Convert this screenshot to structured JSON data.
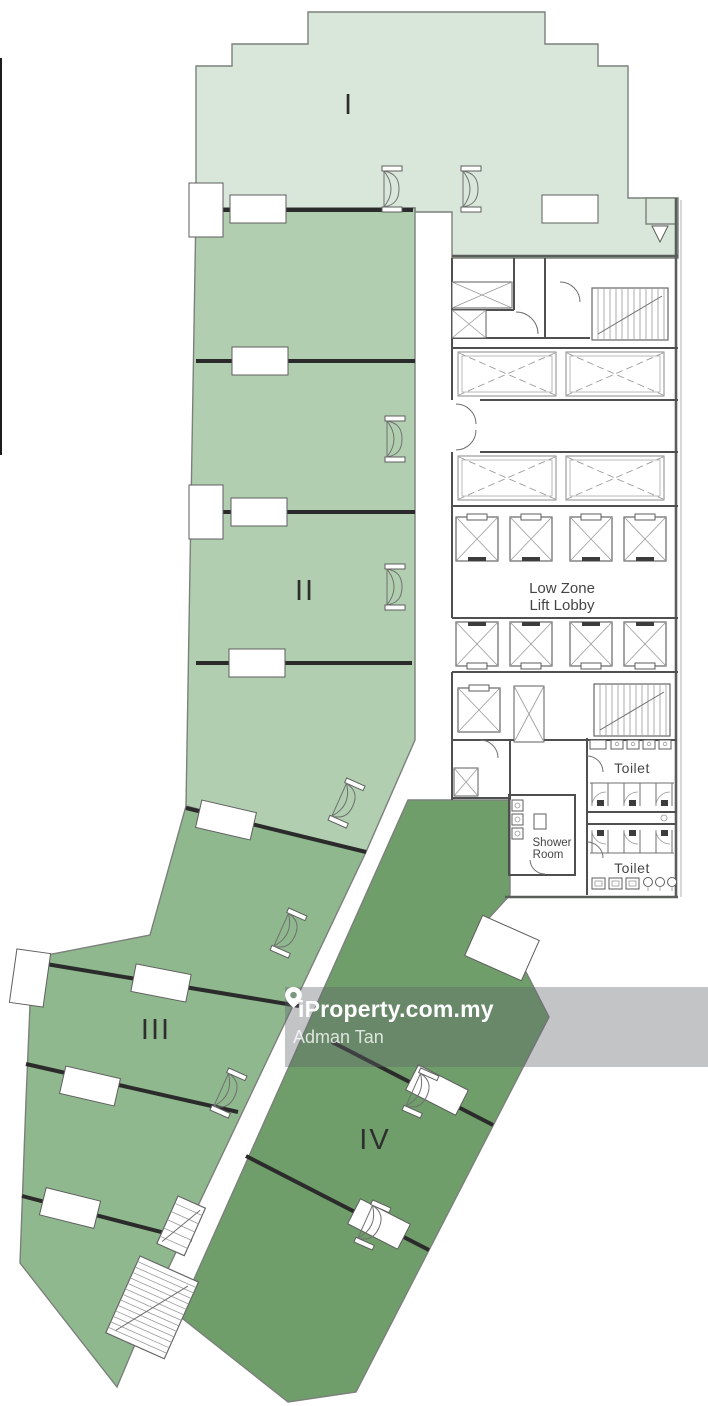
{
  "page": {
    "background": "#ffffff"
  },
  "floor_plan": {
    "zones": [
      {
        "numeral": "I",
        "fill": "#d8e7d9"
      },
      {
        "numeral": "II",
        "fill": "#b1cfb0"
      },
      {
        "numeral": "III",
        "fill": "#90b88e"
      },
      {
        "numeral": "IV",
        "fill": "#6f9e6a"
      }
    ],
    "labels": {
      "lift_lobby_line1": "Low Zone",
      "lift_lobby_line2": "Lift Lobby",
      "toilet_upper": "Toilet",
      "toilet_lower": "Toilet",
      "shower_line1": "Shower",
      "shower_line2": "Room"
    },
    "line_colors": {
      "interior_partition": "#2b2b2b",
      "outer_wall": "#7b807b",
      "core_wall": "#4f4f4f"
    }
  },
  "watermark": {
    "brand": "iProperty.com.my",
    "agent": "Adman Tan",
    "icon": "map-pin-icon",
    "bar_color": "rgba(95,101,106,0.38)",
    "text_color": "#ffffff"
  }
}
